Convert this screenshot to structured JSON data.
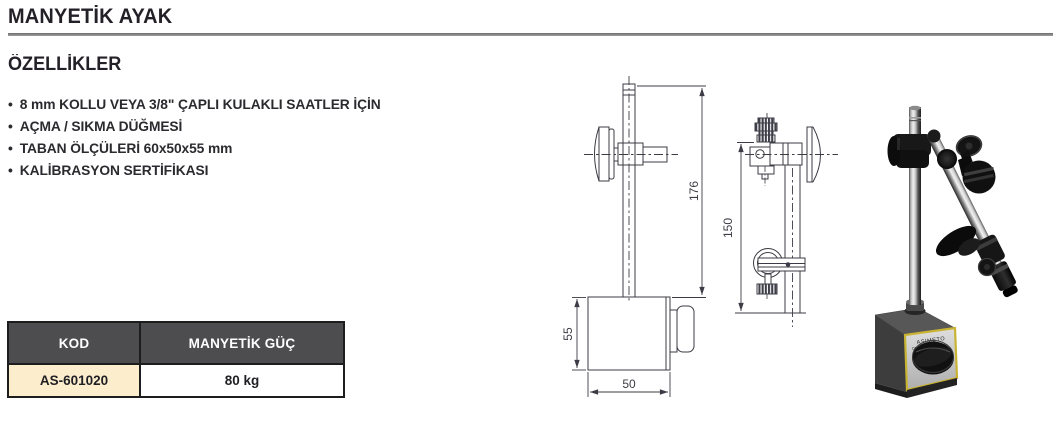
{
  "page": {
    "title": "MANYETİK AYAK"
  },
  "features": {
    "heading": "ÖZELLİKLER",
    "bullet_char": "•",
    "items": [
      "8 mm KOLLU VEYA 3/8\" ÇAPLI KULAKLI SAATLER İÇİN",
      "AÇMA / SIKMA DÜĞMESİ",
      "TABAN ÖLÇÜLERİ 60x50x55 mm",
      "KALİBRASYON SERTİFİKASI"
    ]
  },
  "spec_table": {
    "col_headers": [
      "KOD",
      "MANYETİK GÜÇ"
    ],
    "rows": [
      [
        "AS-601020",
        "80 kg"
      ]
    ]
  },
  "technical_drawing": {
    "front_view": {
      "total_height_mm": "176",
      "base_height_mm": "55",
      "base_width_mm": "50"
    },
    "side_view": {
      "column_height_mm": "150"
    }
  },
  "product_photo": {
    "brand_label": "ASIMETO",
    "switch_label": "ON"
  },
  "colors": {
    "accent_row_bg": "#fcedcd",
    "table_header_bg": "#4d4d4f",
    "table_border": "#1d1d1d",
    "rule_gray": "#7f7f7f",
    "drawing_line": "#3c3c46",
    "base_trim_yellow": "#c9b332"
  }
}
